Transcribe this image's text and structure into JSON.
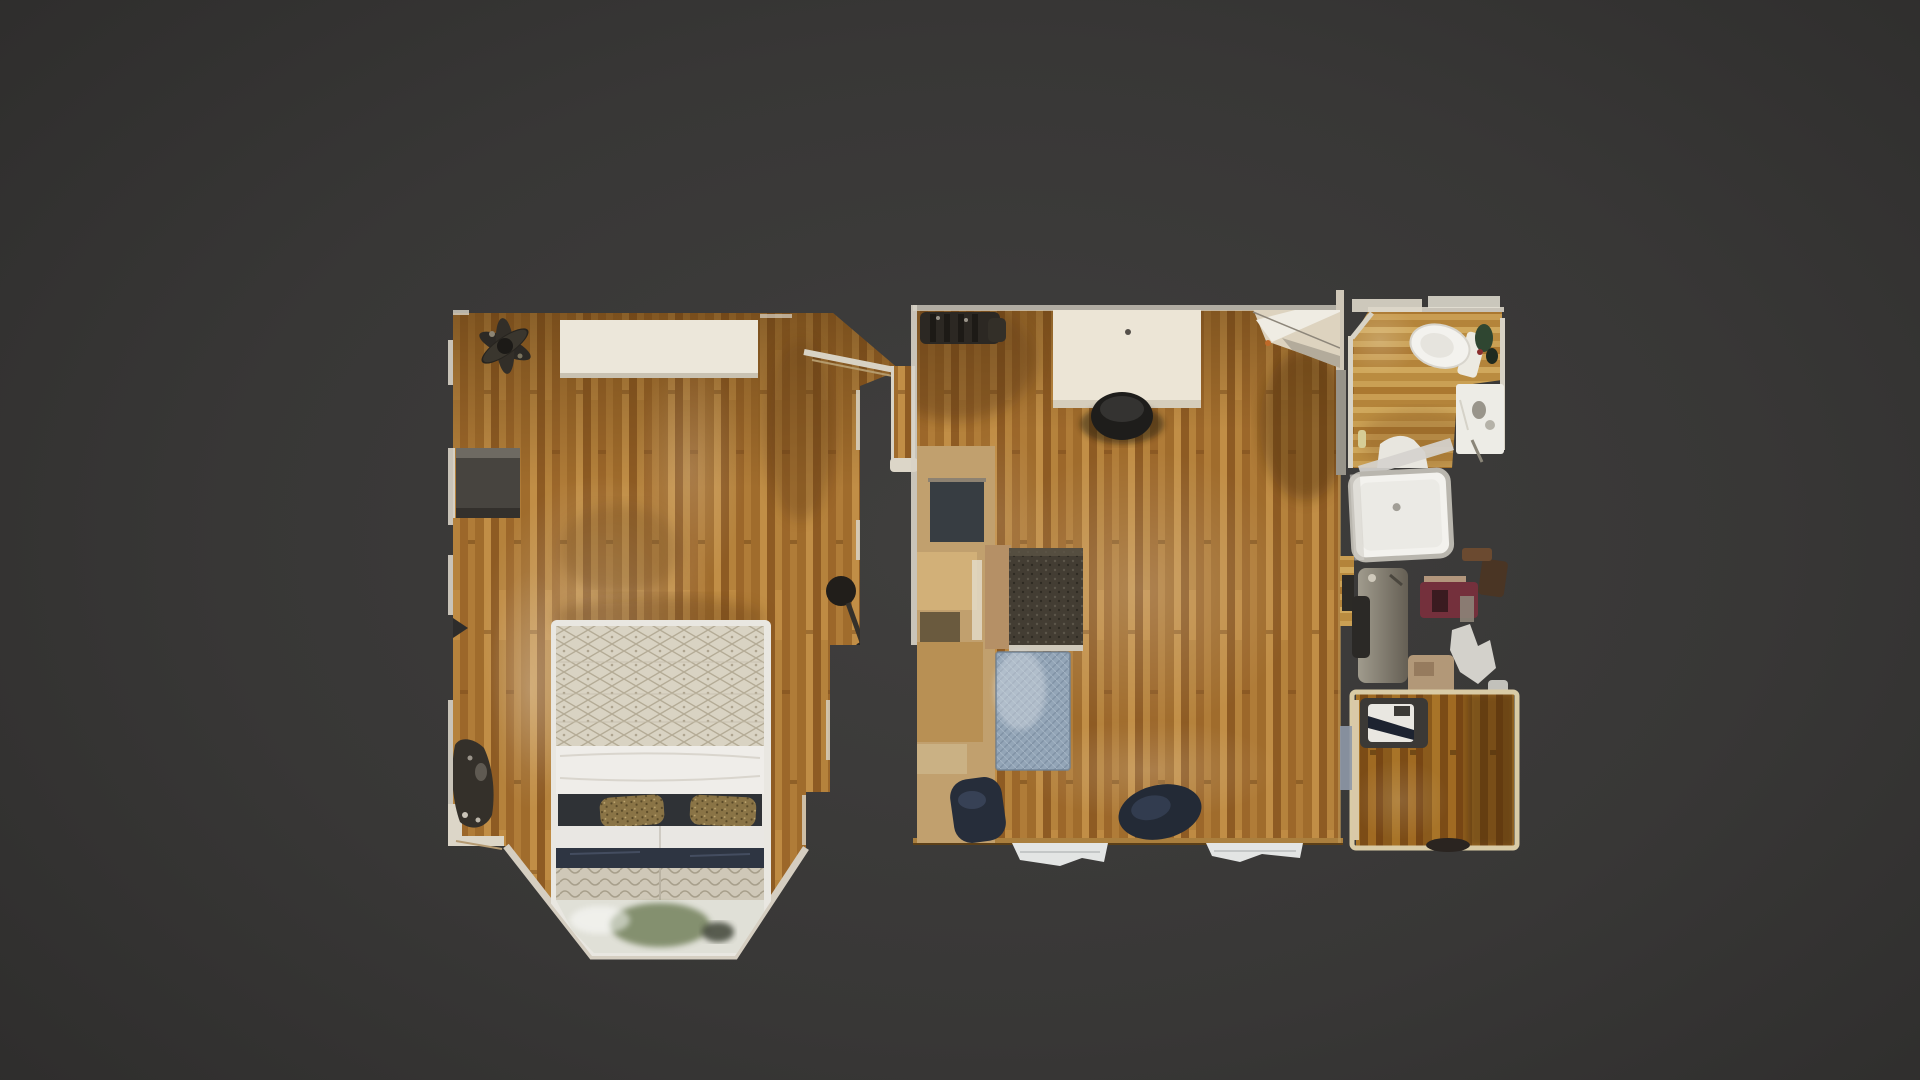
{
  "meta": {
    "description": "Top-down 3D dollhouse floor-plan view of a scanned one-bedroom apartment on a dark viewer canvas",
    "view_mode": "floorplan-top-down"
  },
  "colors": {
    "background": "#383736",
    "background-edge": "#2d2c2b",
    "wood-mid": "#a9762f",
    "wood-light": "#c49d55",
    "wood-dark": "#96621f",
    "wall": "#d8d3c6",
    "cream": "#e9e2d4",
    "fixture": "#f3f2ee",
    "dark-object": "#2c2a27",
    "navy": "#232a36",
    "rug-blue": "#93a5b7",
    "tan": "#b48a52",
    "metal": "#c9ccce",
    "maroon": "#74303c",
    "blanket": "#d9d3c3",
    "sheet": "#efede9",
    "green-plant": "#6d7c55"
  },
  "rooms": [
    "bedroom",
    "living-room",
    "bathroom",
    "closet",
    "walk-in-closet"
  ],
  "furniture": [
    "queen-bed",
    "bed-pillows",
    "dresser",
    "ceiling-fan",
    "nightstand",
    "duffel-bag",
    "round-stool",
    "bay-window",
    "desk",
    "desk-chair",
    "pendant-lamp",
    "shoe-row",
    "wardrobe-console",
    "glass-side-table",
    "armchair",
    "area-rug",
    "dining-chair",
    "floor-cushion",
    "window-sill",
    "toilet",
    "sink-vanity",
    "bathtub",
    "shower-glass",
    "storage-cabinet",
    "hanging-clothes",
    "floor-mat",
    "sewing-machine"
  ]
}
